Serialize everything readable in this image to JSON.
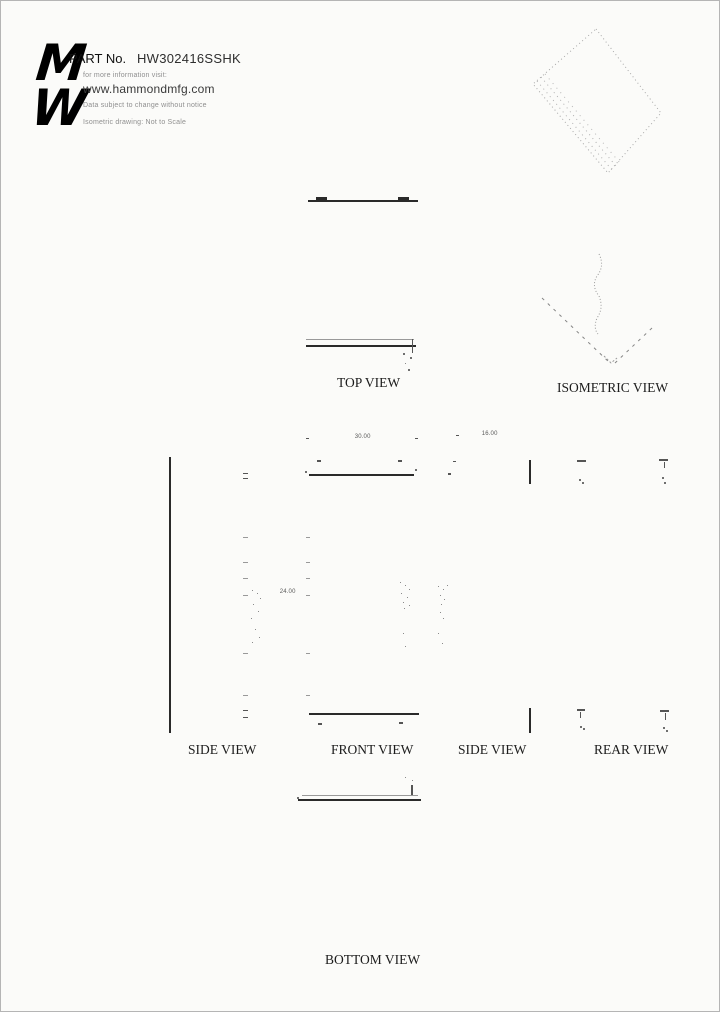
{
  "header": {
    "logo": {
      "top_letter": "M",
      "bottom_letter": "W"
    },
    "part_label": "PART No.",
    "part_number": "HW302416SSHK",
    "info_line": "for more information visit:",
    "website": "www.hammondmfg.com",
    "disclaimer": "Data subject to change without notice",
    "scale_note": "Isometric drawing: Not to Scale"
  },
  "view_labels": {
    "top": "TOP VIEW",
    "isometric": "ISOMETRIC VIEW",
    "side_left": "SIDE VIEW",
    "front": "FRONT VIEW",
    "side_right": "SIDE VIEW",
    "rear": "REAR VIEW",
    "bottom": "BOTTOM VIEW"
  },
  "dimensions": {
    "width": "30.00",
    "depth": "16.00",
    "height": "24.00"
  },
  "colors": {
    "line_dark": "#222222",
    "line_faint": "#999999",
    "text_gray": "#8f8f8f"
  }
}
